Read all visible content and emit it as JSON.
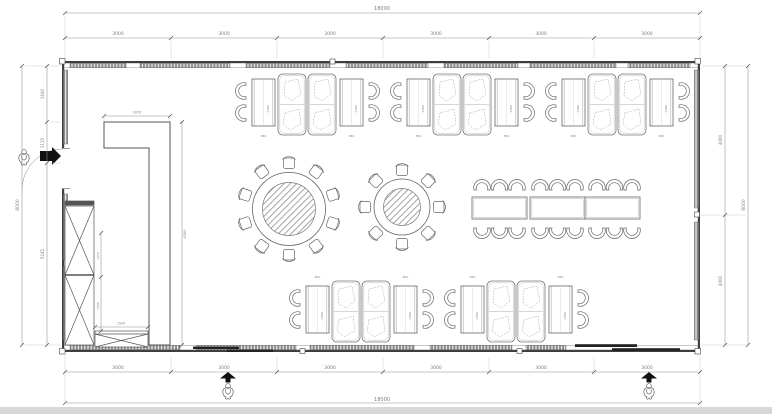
{
  "dimensions": {
    "top": {
      "overall": "18000",
      "segments": [
        "3000",
        "3000",
        "3000",
        "3000",
        "3000",
        "3000"
      ]
    },
    "bottom": {
      "overall": "18000",
      "segments": [
        "3000",
        "3000",
        "3000",
        "3000",
        "3000",
        "3000"
      ]
    },
    "left": {
      "overall": "8000",
      "segments": [
        "1640",
        "1115",
        "5245"
      ]
    },
    "right": {
      "overall": "8000",
      "segments": [
        "4000",
        "4000"
      ]
    },
    "interior": {
      "booth_table_length": "1300",
      "booth_table_width": "650",
      "partition_top_width": "1870",
      "partition_height": "6300",
      "service_counter_width": "1500",
      "cabinet_section_a": "1250",
      "cabinet_section_b": "1500"
    }
  },
  "plan_contents": {
    "type": "dining-room floor plan",
    "booth_groups_top_row": 3,
    "booth_groups_bottom_row": 2,
    "seats_per_booth_group": 8,
    "round_table_large_seats": 10,
    "round_table_small_seats": 8,
    "banquet_tables": 3,
    "banquet_seats": 18,
    "entrances": 3
  }
}
